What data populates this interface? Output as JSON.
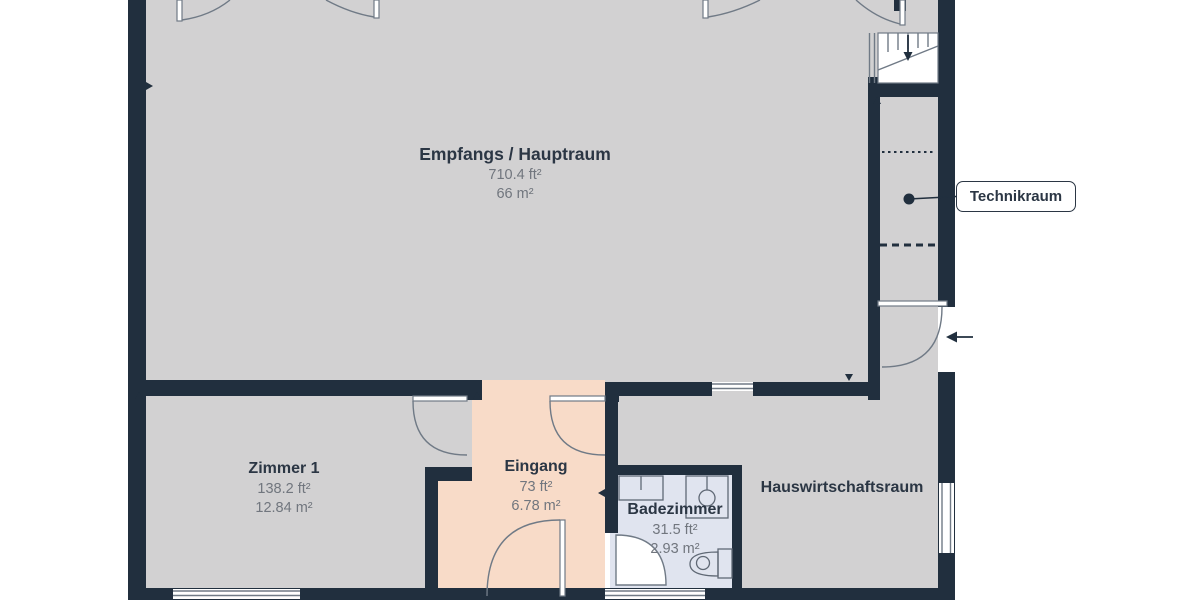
{
  "plan": {
    "rooms": [
      {
        "name": "Empfangs / Hauptraum",
        "area_ft": "710.4 ft²",
        "area_m": "66 m²"
      },
      {
        "name": "Zimmer 1",
        "area_ft": "138.2 ft²",
        "area_m": "12.84 m²"
      },
      {
        "name": "Eingang",
        "area_ft": "73 ft²",
        "area_m": "6.78 m²"
      },
      {
        "name": "Badezimmer",
        "area_ft": "31.5 ft²",
        "area_m": "2.93 m²"
      },
      {
        "name": "Hauswirtschaftsraum"
      },
      {
        "name": "Technikraum"
      }
    ],
    "icons": {
      "stairs_arrow": "down-arrow",
      "entry_arrow": "left-arrow",
      "technikraum_marker": "dot-with-leader-line"
    }
  },
  "colors": {
    "background": "#ffffff",
    "wall": "#212f3e",
    "floor": "#d2d1d2",
    "entry_floor": "#f8dbc8",
    "bath_floor": "#e0e4ef",
    "outline": "#707a86",
    "fixture": "#5f6875",
    "label_dark": "#2b3644",
    "label_gray": "#71767e"
  }
}
